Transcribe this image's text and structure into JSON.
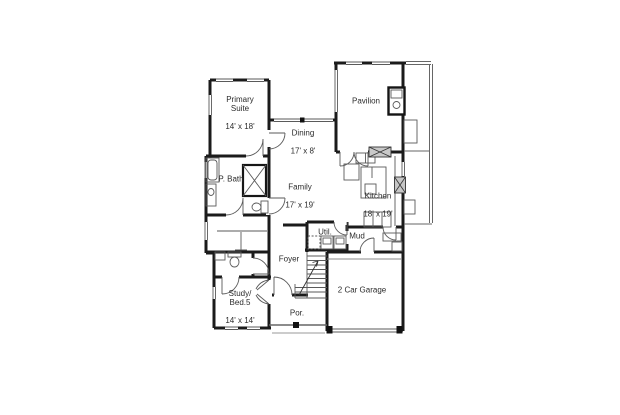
{
  "document": {
    "type": "first-floor-plan",
    "background_color": "#ffffff",
    "wall_color": "#1b1b1b",
    "line_color": "#5a5a5a",
    "hatch_color": "#c6c6c6",
    "text_color": "#2b2b2b"
  },
  "rooms": {
    "primary_suite": {
      "name": "Primary\nSuite",
      "dims": "14' x 18'"
    },
    "p_bath": {
      "name": "P. Bath",
      "dims": ""
    },
    "dining": {
      "name": "Dining",
      "dims": "17' x 8'"
    },
    "pavilion": {
      "name": "Pavilion",
      "dims": ""
    },
    "family": {
      "name": "Family",
      "dims": "17' x 19'"
    },
    "kitchen": {
      "name": "Kitchen",
      "dims": "18' x 19'"
    },
    "util": {
      "name": "Util.",
      "dims": ""
    },
    "mud": {
      "name": "Mud",
      "dims": ""
    },
    "foyer": {
      "name": "Foyer",
      "dims": ""
    },
    "study": {
      "name": "Study/\nBed.5",
      "dims": "14' x 14'"
    },
    "porch": {
      "name": "Por.",
      "dims": ""
    },
    "garage": {
      "name": "2 Car Garage",
      "dims": ""
    }
  }
}
